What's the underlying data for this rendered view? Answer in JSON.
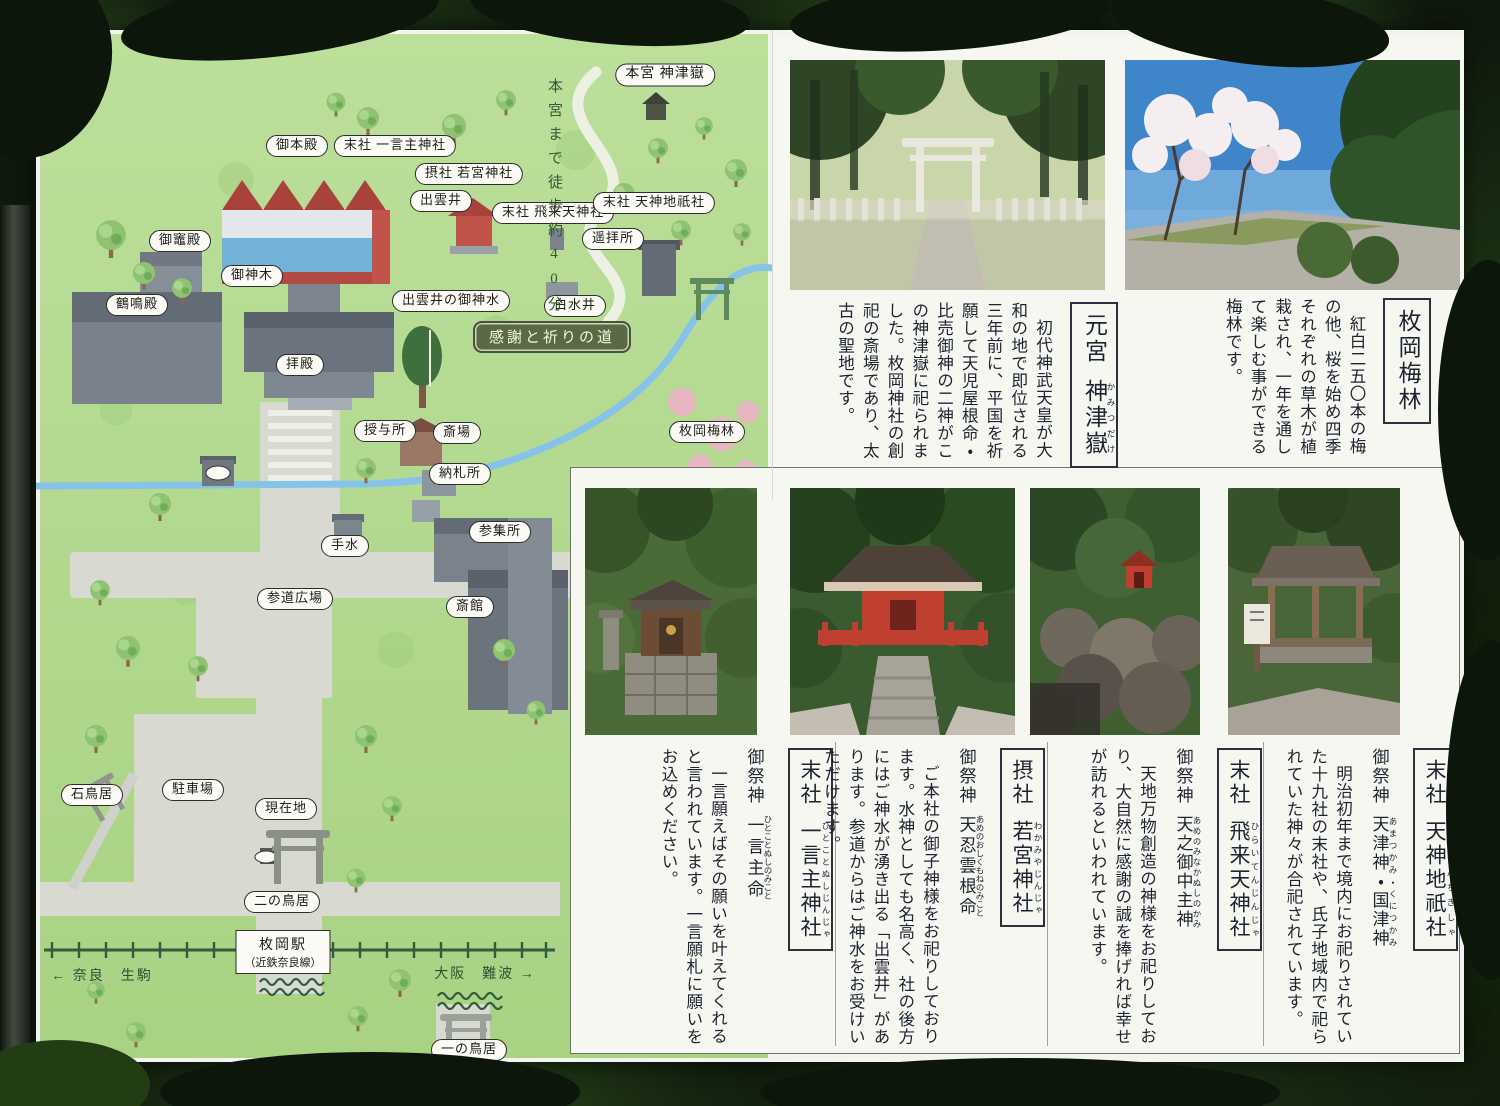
{
  "map": {
    "walk_note": "本宮まで徒歩約40分",
    "path_badge": "感謝と祈りの道",
    "station": {
      "name": "枚岡駅",
      "line": "（近鉄奈良線）"
    },
    "directions": {
      "west": "← 奈良　生駒",
      "east": "大阪　難波 →"
    },
    "labels": {
      "honguu": "本宮 神津嶽",
      "gohonden": "御本殿",
      "massha_hitokotonushi": "末社 一言主神社",
      "sessha_wakamiya": "摂社 若宮神社",
      "izumoi": "出雲井",
      "massha_hiraitenjin": "末社 飛来天神社",
      "massha_tenjinchigi": "末社 天神地祇社",
      "youhaijo": "遥拝所",
      "mikamadoden": "御竈殿",
      "goshinboku": "御神木",
      "kakumeiden": "鶴鳴殿",
      "izumoi_goshinsui": "出雲井の御神水",
      "hakusuii": "白水井",
      "haiden": "拝殿",
      "juyosho": "授与所",
      "saijou": "斎場",
      "nousatsusho": "納札所",
      "temizu": "手水",
      "sanshujo": "参集所",
      "saikan": "斎館",
      "hiraoka_bairin": "枚岡梅林",
      "sando_hiroba": "参道広場",
      "chushajo": "駐車場",
      "ishitorii": "石鳥居",
      "genzaichi": "現在地",
      "ni_no_torii": "二の鳥居",
      "ichi_no_torii": "一の鳥居"
    }
  },
  "sections": {
    "kamitsudake": {
      "prefix": "元宮",
      "name": "神津嶽",
      "furigana": "かみつだけ",
      "body": "初代神武天皇が大和の地で即位される三年前に、平国を祈願して天児屋根命・比売御神の二神がこの神津嶽に祀られました。枚岡神社の創祀の斎場であり、太古の聖地です。"
    },
    "bairin": {
      "name": "枚岡梅林",
      "body": "紅白二五〇本の梅の他、桜を始め四季それぞれの草木が植栽され、一年を通して楽しむ事ができる梅林です。"
    },
    "hitokotonushi": {
      "prefix": "末社",
      "name": "一言主神社",
      "furigana": "ひとことぬしじんじゃ",
      "deity_label": "御祭神",
      "deity": "一言主命",
      "deity_furigana": "ひとことぬしのみこと",
      "body": "一言願えばその願いを叶えてくれると言われています。一言願札に願いをお込めください。"
    },
    "wakamiya": {
      "prefix": "摂社",
      "name": "若宮神社",
      "furigana": "わかみやじんじゃ",
      "deity_label": "御祭神",
      "deity": "天忍雲根命",
      "deity_furigana": "あめのおしくもねのみこと",
      "body": "ご本社の御子神様をお祀りしております。水神としても名高く、社の後方にはご神水が湧き出る「出雲井」があります。参道からはご神水をお受けいただけます。"
    },
    "hiraitenjin": {
      "prefix": "末社",
      "name": "飛来天神社",
      "furigana": "ひらいてんじんじゃ",
      "deity_label": "御祭神",
      "deity": "天之御中主神",
      "deity_furigana": "あめのみなかぬしのかみ",
      "body": "天地万物創造の神様をお祀りしており、大自然に感謝の誠を捧げれば幸せが訪れるといわれています。"
    },
    "tenjinchigi": {
      "prefix": "末社",
      "name": "天神地祇社",
      "furigana": "てんしんちぎしゃ",
      "deity_label": "御祭神",
      "deity": "天津神・国津神",
      "deity_furigana": "あまつかみ・くにつかみ",
      "body": "明治初年まで境内にお祀りされていた十九社の末社や、氏子地域内で祀られていた神々が合祀されています。"
    }
  },
  "colors": {
    "map_green": "#b5d890",
    "road_grey": "#d8dad2",
    "stream_blue": "#85c3e9",
    "rail_green": "#2f5d3d",
    "roof_red": "#a8423b",
    "shrine_vermilion": "#c0544b",
    "wall_blue": "#72b2d9"
  }
}
